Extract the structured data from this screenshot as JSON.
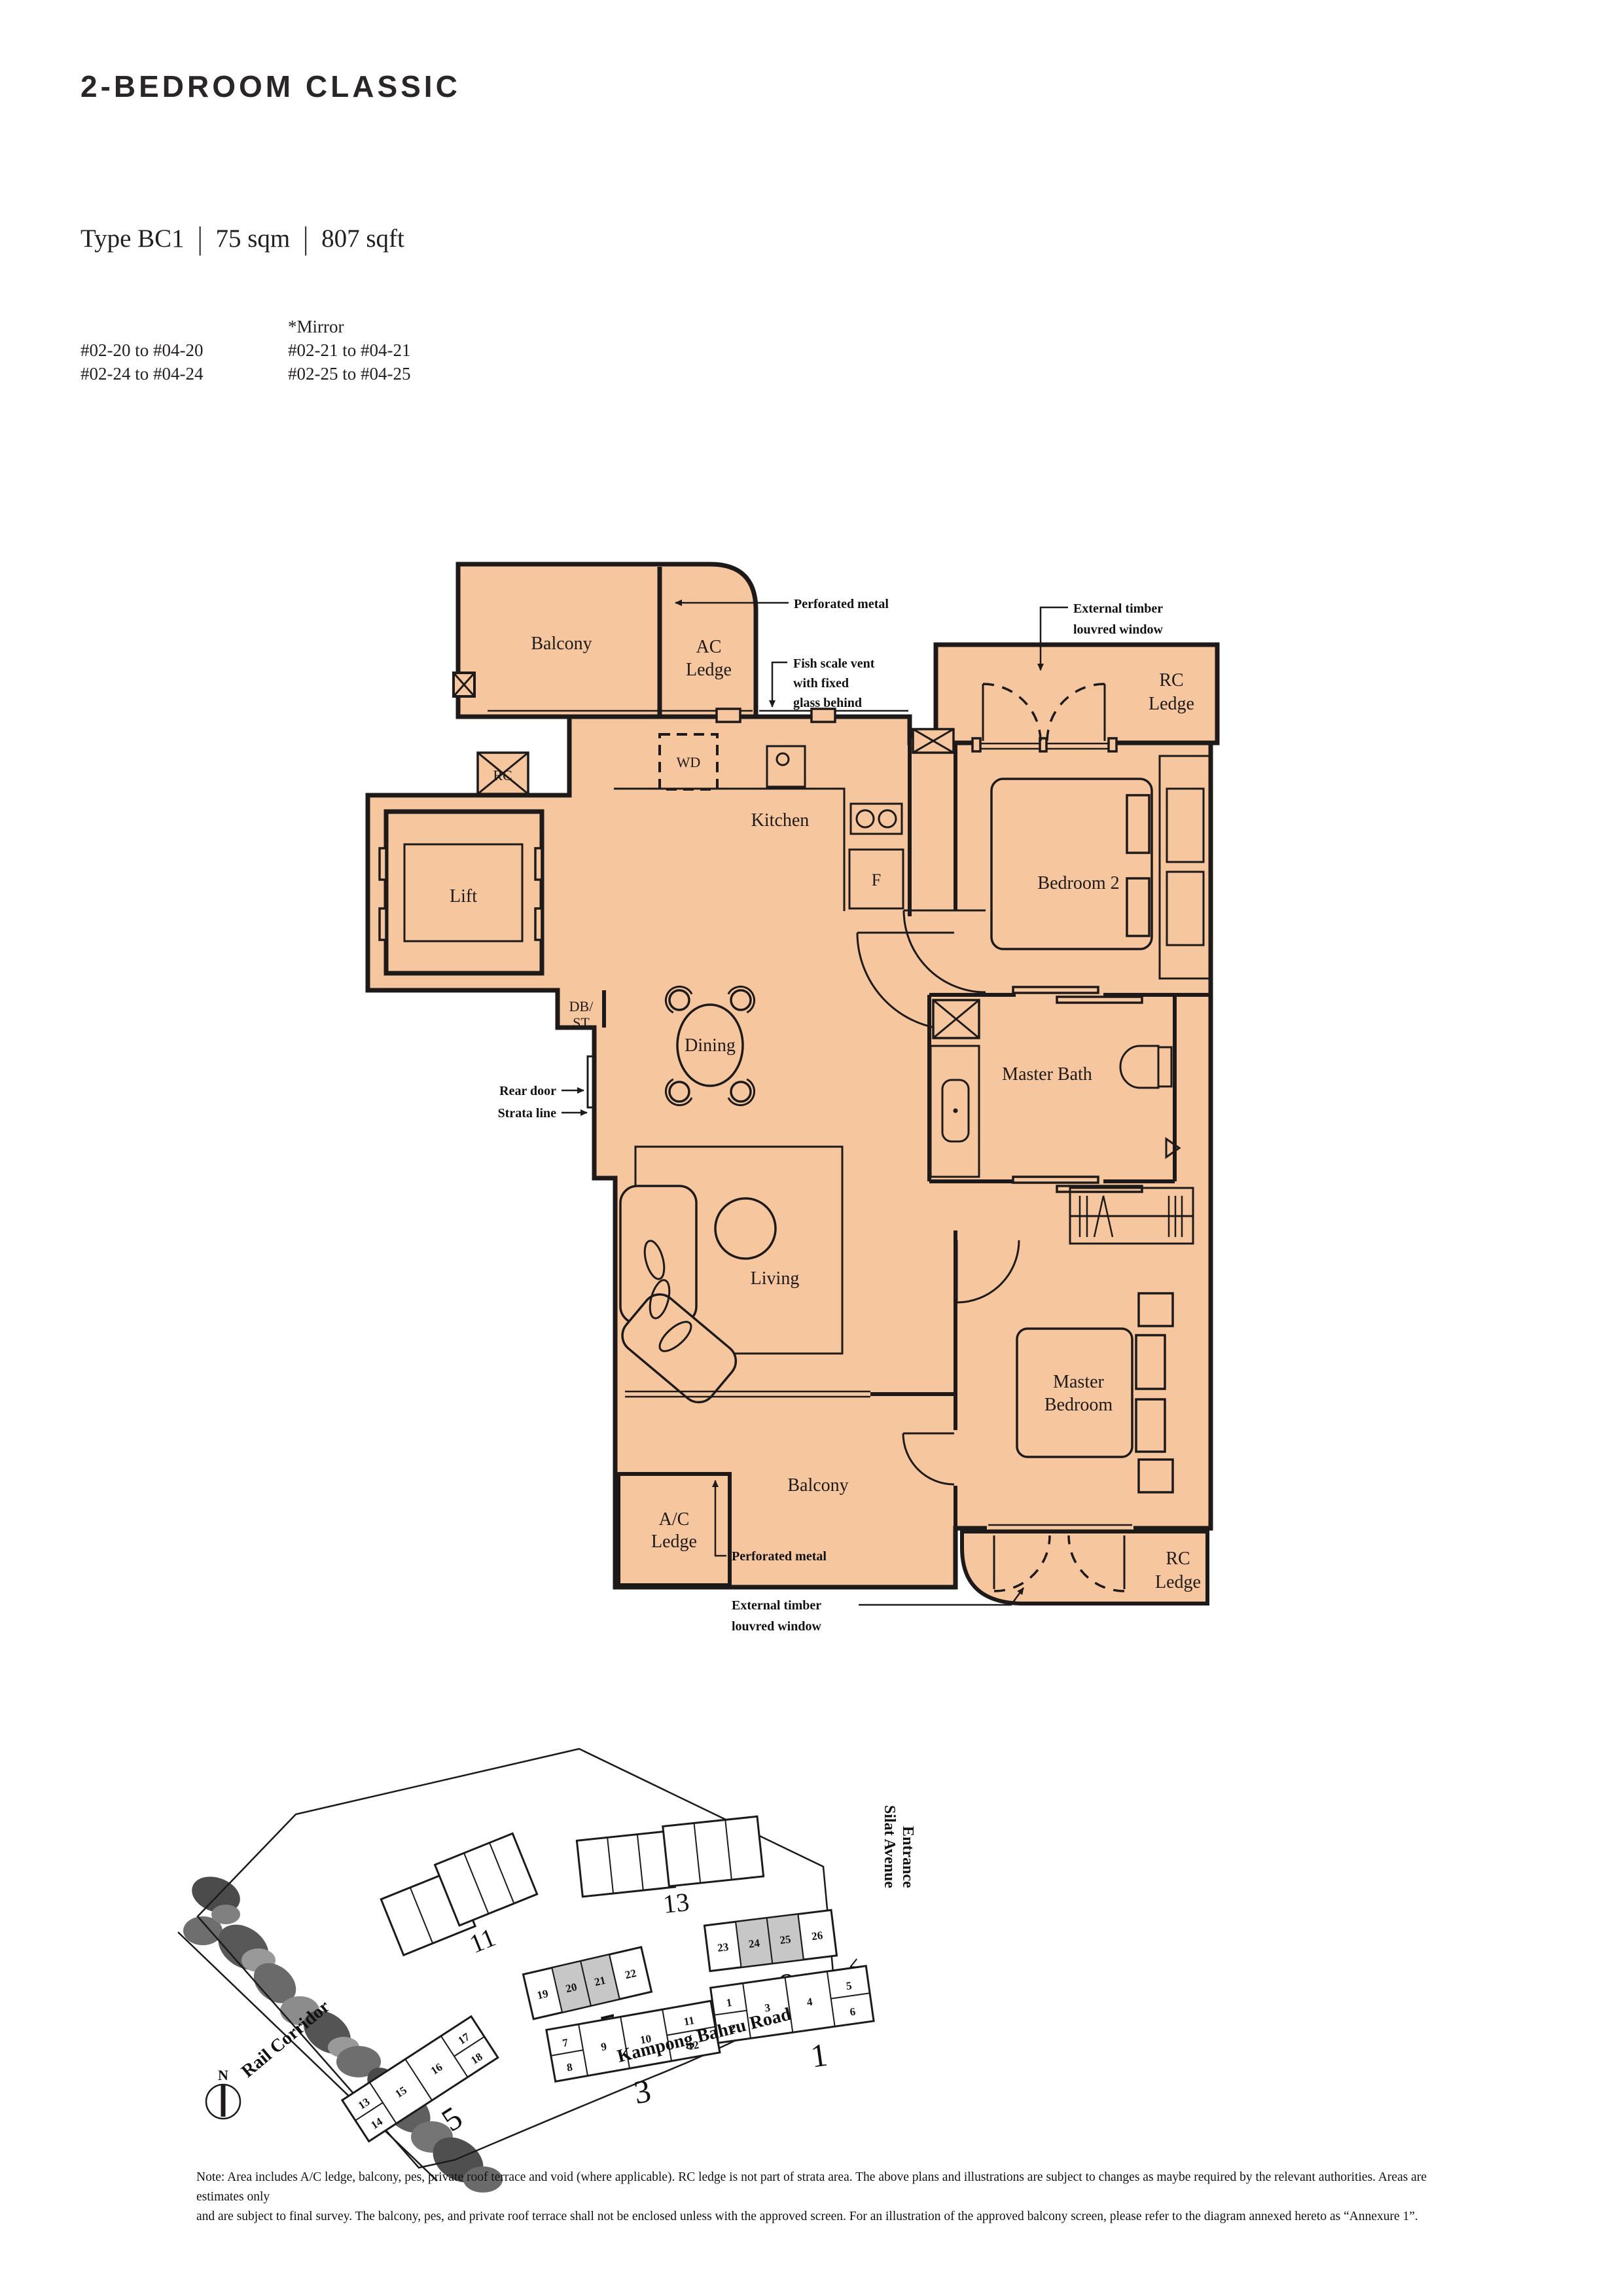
{
  "header": {
    "title": "2-BEDROOM CLASSIC",
    "type": {
      "label": "Type BC1",
      "sqm": "75 sqm",
      "sqft": "807 sqft",
      "sep": "|"
    },
    "units": {
      "left": [
        "#02-20 to #04-20",
        "#02-24 to #04-24"
      ],
      "mirror": "*Mirror",
      "right": [
        "#02-21 to #04-21",
        "#02-25 to #04-25"
      ]
    }
  },
  "fp": {
    "balcony_top": "Balcony",
    "ac_ledge": [
      "AC",
      "Ledge"
    ],
    "rc_tl": "RC",
    "lift": "Lift",
    "dbst": [
      "DB/",
      "ST"
    ],
    "wd": "WD",
    "kitchen": "Kitchen",
    "f": "F",
    "dining": "Dining",
    "living": "Living",
    "bedroom2": "Bedroom 2",
    "master_bath": "Master Bath",
    "master_bedroom": [
      "Master",
      "Bedroom"
    ],
    "balcony_bottom": "Balcony",
    "ac_ledge_bottom": [
      "A/C",
      "Ledge"
    ],
    "rc_ledge_tr": [
      "RC",
      "Ledge"
    ],
    "rc_ledge_br": [
      "RC",
      "Ledge"
    ]
  },
  "ann": {
    "perforated_top": "Perforated metal",
    "fish_scale": [
      "Fish scale vent",
      "with fixed",
      "glass behind"
    ],
    "timber_tr": [
      "External timber",
      "louvred window"
    ],
    "rear_door": "Rear door",
    "strata_line": "Strata line",
    "perforated_bottom": "Perforated metal",
    "timber_br": [
      "External timber",
      "louvred window"
    ]
  },
  "site_map": {
    "b11": {
      "num": "11"
    },
    "b13": {
      "num": "13"
    },
    "b9": {
      "num": "9",
      "units": [
        "23",
        "24",
        "25",
        "26"
      ]
    },
    "b7": {
      "num": "7",
      "units": [
        "19",
        "20",
        "21",
        "22"
      ]
    },
    "b3": {
      "num": "3",
      "units": [
        "7",
        "8",
        "9",
        "10",
        "11",
        "12"
      ]
    },
    "b1": {
      "num": "1",
      "units": [
        "1",
        "2",
        "3",
        "4",
        "5",
        "6"
      ]
    },
    "b5": {
      "num": "5",
      "units": [
        "13",
        "14",
        "15",
        "16",
        "17",
        "18"
      ]
    },
    "highlighted_units": [
      "20",
      "21",
      "24",
      "25"
    ],
    "roads": {
      "rail": "Rail Corridor",
      "kampong": "Kampong Bahru Road",
      "silat": [
        "Silat Avenue",
        "Entrance"
      ]
    },
    "compass": "N",
    "entrance_arrow": "<"
  },
  "note": {
    "line1": "Note: Area includes A/C ledge, balcony, pes, private roof terrace and void (where applicable). RC ledge is not part of strata area. The above plans and illustrations are subject to changes as maybe required by the relevant authorities. Areas are estimates only",
    "line2": "and are subject to final survey. The balcony, pes, and private roof terrace shall not be enclosed unless with the approved screen. For an illustration of the approved balcony screen, please refer to the diagram annexed hereto as “Annexure 1”."
  },
  "colors": {
    "plan_fill": "#F6C79F",
    "line": "#1D1A19",
    "highlight": "#C7C7C7"
  }
}
